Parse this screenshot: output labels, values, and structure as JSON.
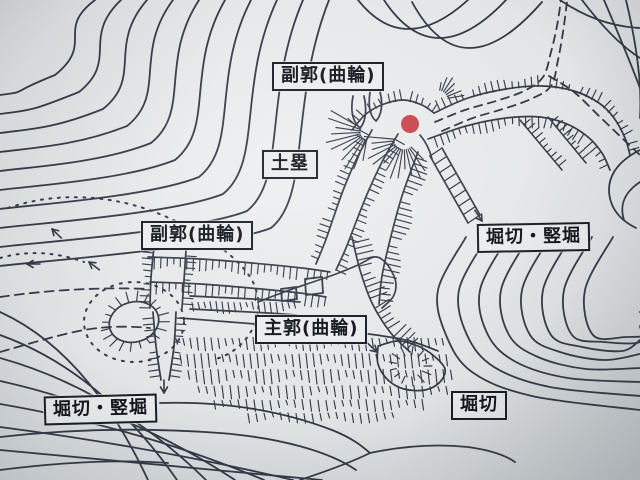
{
  "map": {
    "title": "castle-earthworks-contour-map",
    "labels": {
      "fukukaku_top": "副郭(曲輪)",
      "dorui": "土塁",
      "fukukaku_left": "副郭(曲輪)",
      "horikiri_tatebori_right": "堀切・竪堀",
      "shukaku": "主郭(曲輪)",
      "horikiri_tatebori_left": "堀切・竪堀",
      "horikiri_bottom_right": "堀切"
    },
    "marker": {
      "name": "red-location-dot",
      "color": "#c9454b"
    },
    "colors": {
      "ink": "#323945",
      "paper": "#e4e7e8",
      "label_bg": "#eaeced",
      "label_border": "#171c24"
    }
  }
}
